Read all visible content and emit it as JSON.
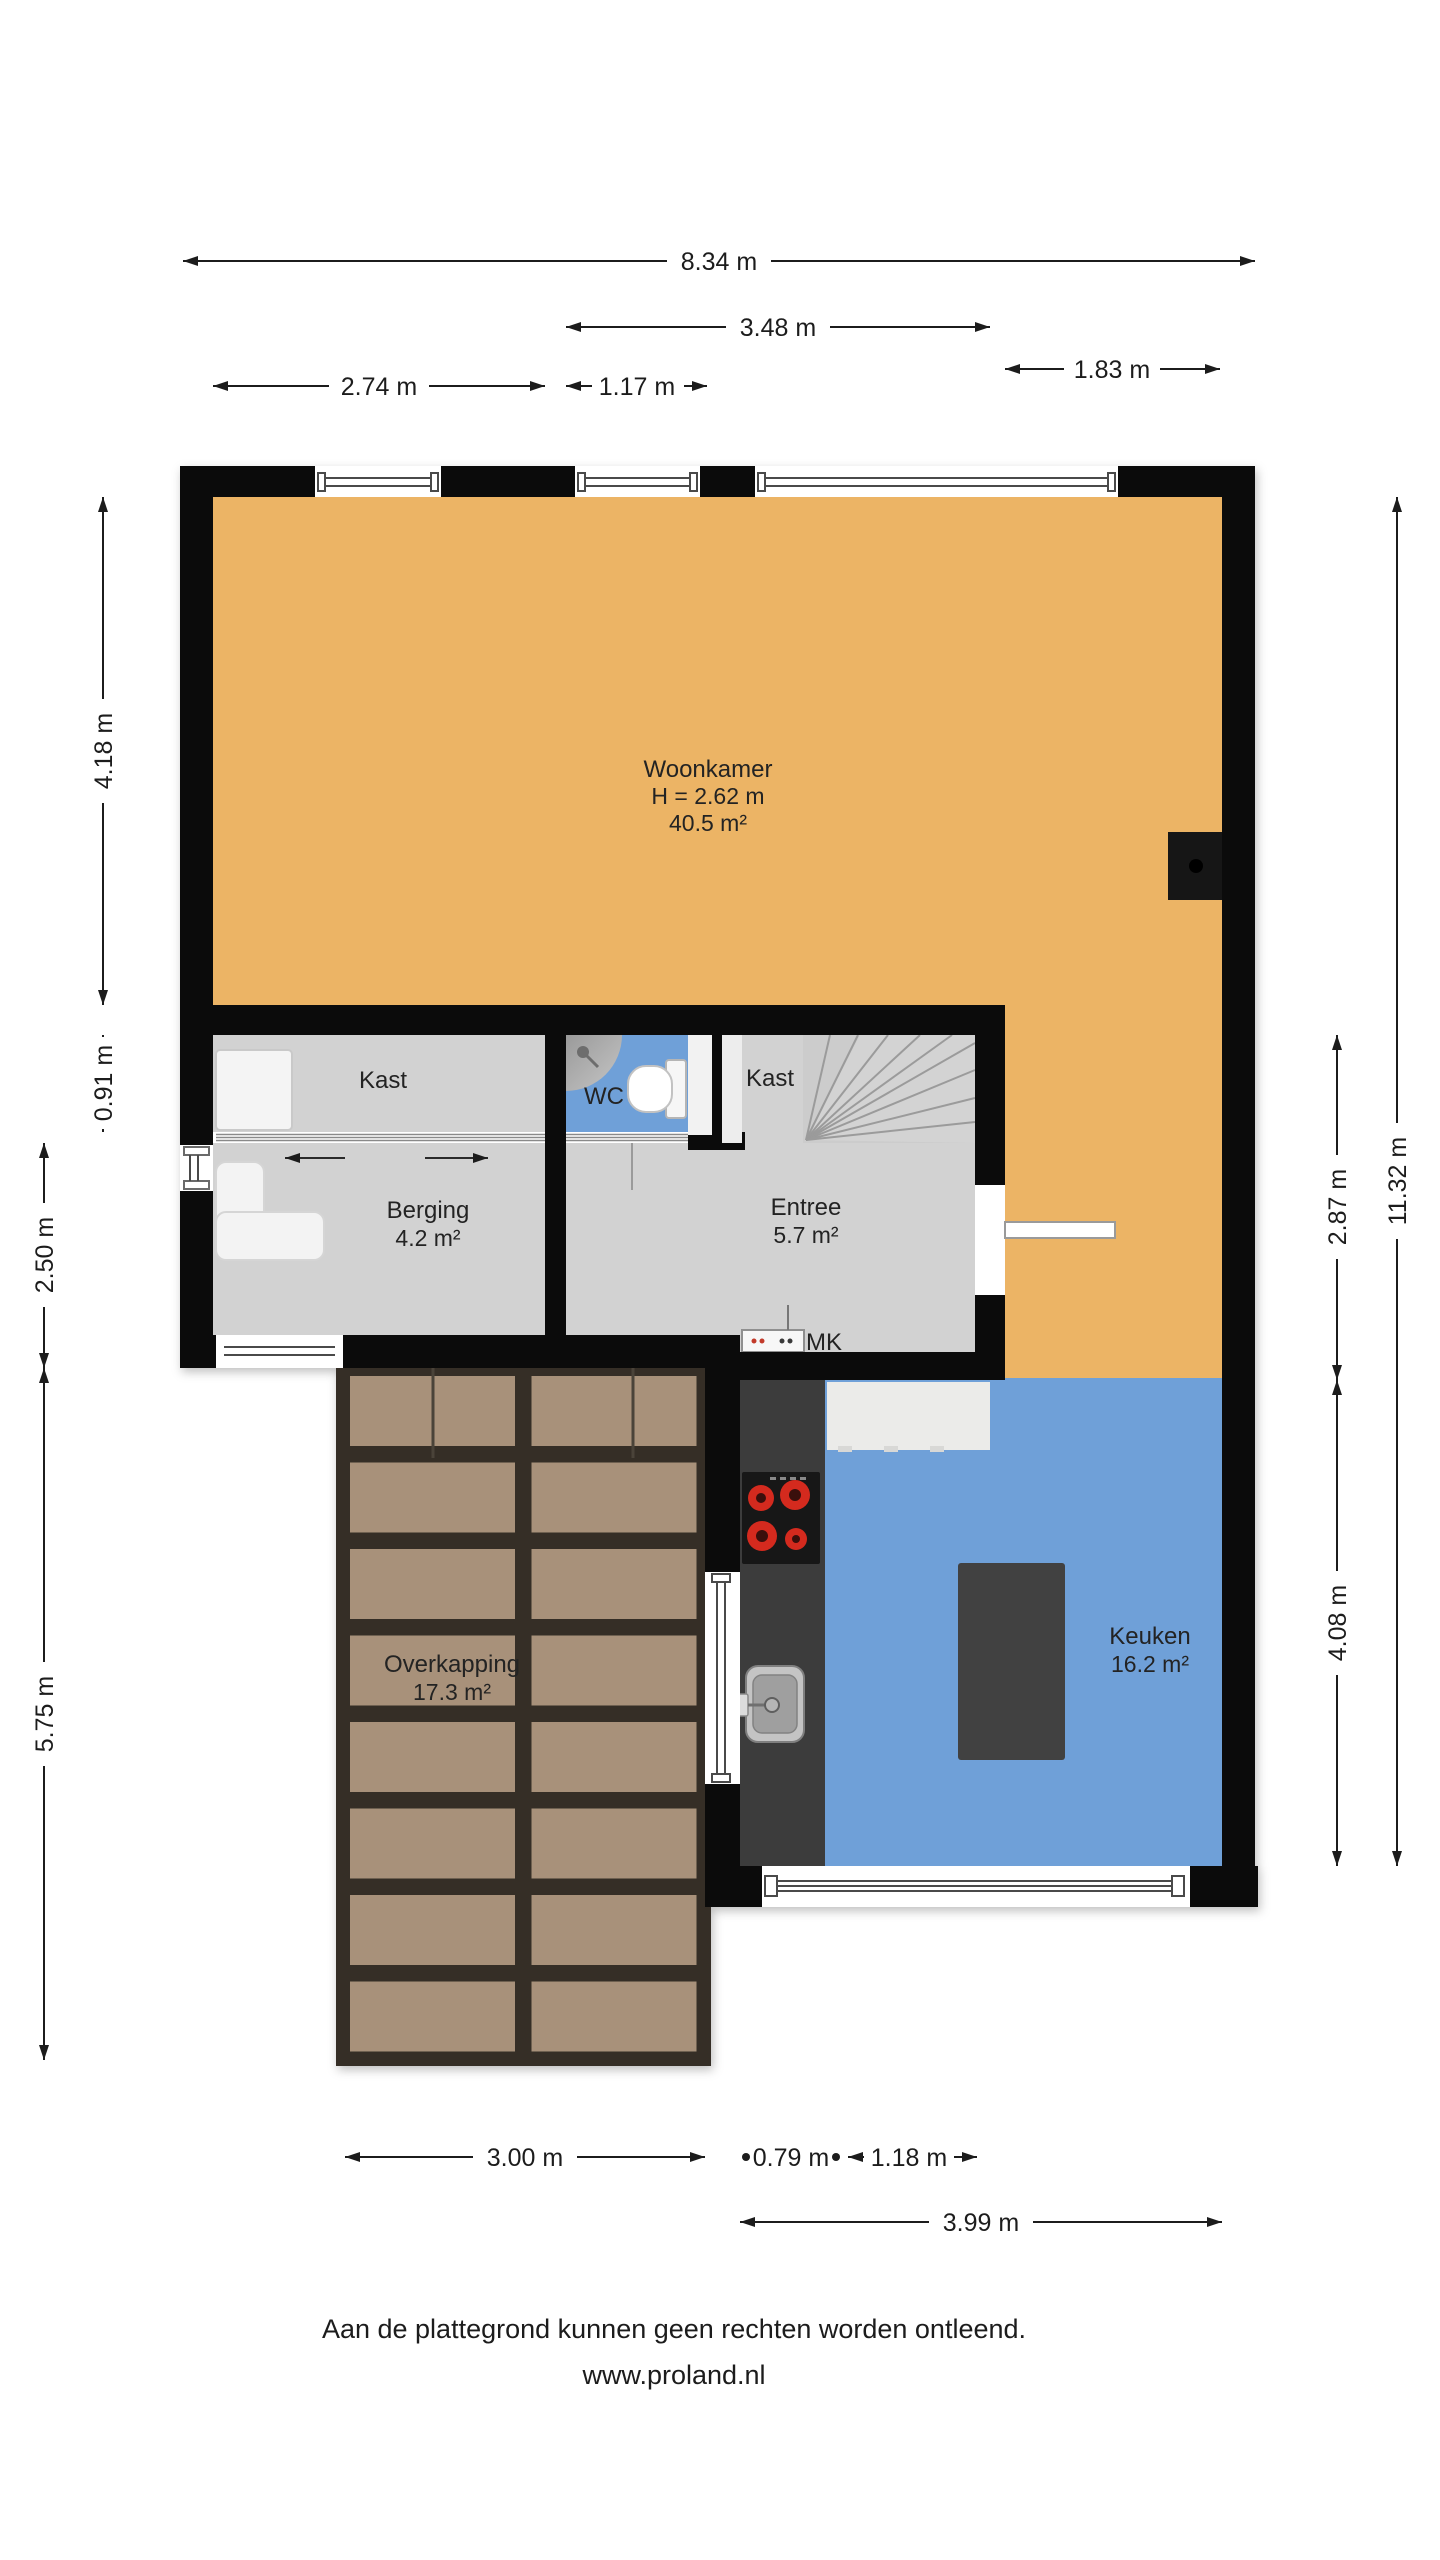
{
  "plan_title": "Begane grond plattegrond",
  "rooms": {
    "woonkamer": {
      "name": "Woonkamer",
      "ceiling_height": "H = 2.62 m",
      "area": "40.5 m²"
    },
    "kast_links": {
      "name": "Kast"
    },
    "wc": {
      "name": "WC"
    },
    "kast_entree": {
      "name": "Kast"
    },
    "berging": {
      "name": "Berging",
      "area": "4.2 m²"
    },
    "entree": {
      "name": "Entree",
      "area": "5.7 m²"
    },
    "overkapping": {
      "name": "Overkapping",
      "area": "17.3 m²"
    },
    "keuken": {
      "name": "Keuken",
      "area": "16.2 m²"
    },
    "meterkast": {
      "name": "MK"
    }
  },
  "dimensions": {
    "top": {
      "total": "8.34 m",
      "entree_block": "3.48 m",
      "left_section": "2.74 m",
      "wc_section": "1.17 m",
      "right_section": "1.83 m"
    },
    "left": {
      "woonkamer": "4.18 m",
      "kast": "0.91 m",
      "berging": "2.50 m",
      "overkapping": "5.75 m"
    },
    "right": {
      "middle": "2.87 m",
      "keuken": "4.08 m",
      "total": "11.32 m"
    },
    "bottom": {
      "overkapping": "3.00 m",
      "counter": "0.79 m",
      "worktop": "1.18 m",
      "keuken": "3.99 m"
    }
  },
  "footer": {
    "disclaimer": "Aan de plattegrond kunnen geen rechten worden ontleend.",
    "website": "www.proland.nl"
  },
  "colors": {
    "wall": "#0b0b0b",
    "floor_wood": "#ecb465",
    "floor_gray": "#d3d3d3",
    "floor_blue": "#6fa0d8",
    "tile": "#a8917a",
    "grout": "#352e26",
    "counter": "#3c3c3c",
    "burner_red": "#d42a1e"
  }
}
